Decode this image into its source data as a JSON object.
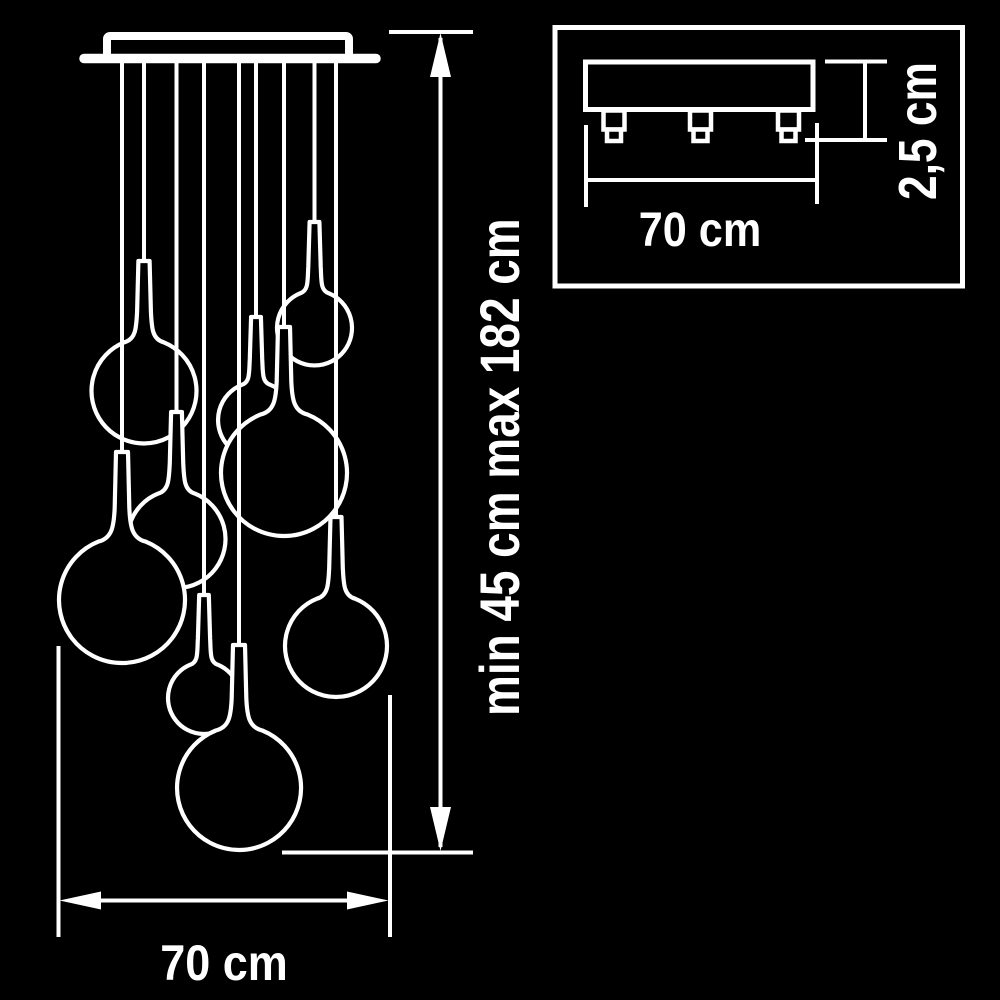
{
  "colors": {
    "background": "#000000",
    "line": "#ffffff"
  },
  "labels": {
    "height_range": "min 45 cm max 182 cm",
    "main_width": "70 cm",
    "inset_width": "70 cm",
    "inset_height": "2,5 cm"
  },
  "diagram": {
    "type": "pendant-chandelier-dimension-drawing",
    "canopy": {
      "plate": {
        "x1": 84,
        "x2": 376,
        "y": 58.5,
        "thickness": 9.5
      },
      "box": {
        "x": 107,
        "y": 36,
        "w": 242,
        "h": 23
      }
    },
    "pendants": [
      {
        "id": "b",
        "x": 144,
        "neck_top": 261,
        "cy": 391,
        "r": 52.5
      },
      {
        "id": "c",
        "x": 176.5,
        "neck_top": 412,
        "cy": 539,
        "r": 49
      },
      {
        "id": "a",
        "x": 122,
        "neck_top": 452,
        "cy": 600,
        "r": 63
      },
      {
        "id": "h",
        "x": 314.5,
        "neck_top": 222,
        "cy": 328,
        "r": 37.5
      },
      {
        "id": "f",
        "x": 256,
        "neck_top": 317,
        "cy": 420,
        "r": 38
      },
      {
        "id": "g",
        "x": 284,
        "neck_top": 327,
        "cy": 473,
        "r": 63
      },
      {
        "id": "d",
        "x": 204,
        "neck_top": 595,
        "cy": 698,
        "r": 36
      },
      {
        "id": "e",
        "x": 239,
        "neck_top": 645,
        "cy": 788,
        "r": 62
      },
      {
        "id": "i",
        "x": 336,
        "neck_top": 517,
        "cy": 646,
        "r": 51
      }
    ],
    "inset": {
      "border": {
        "x": 555,
        "y": 27.5,
        "w": 407.5,
        "h": 258.5
      },
      "plate": {
        "x": 585.5,
        "y": 62,
        "w": 227.5,
        "h": 47.5
      },
      "connectors_x": [
        614,
        700.5,
        788.5
      ]
    }
  }
}
